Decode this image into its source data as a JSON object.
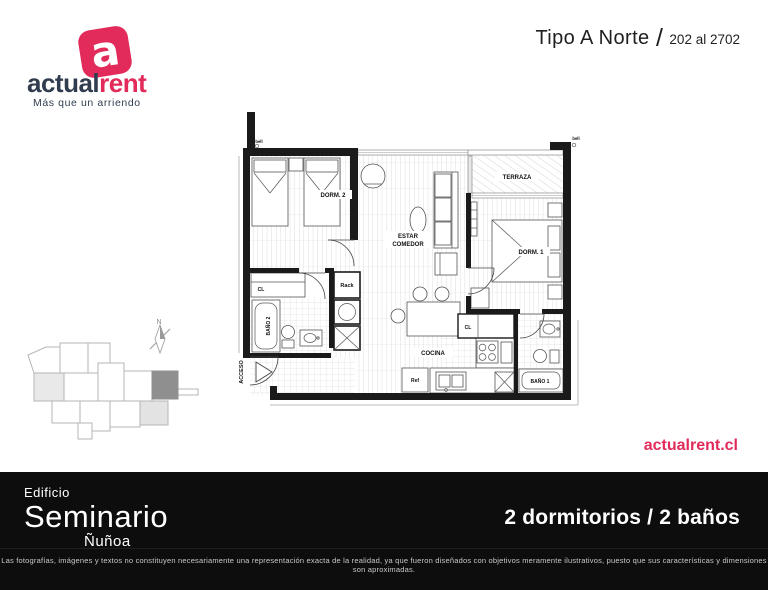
{
  "colors": {
    "accent": "#e22b5a",
    "navy": "#303d4f",
    "footer_bg": "#0d0d0d",
    "wall": "#1a1a1a",
    "keyplan_highlight": "#8f8f8f"
  },
  "header": {
    "logo": {
      "icon_letter": "a",
      "brand_bold": "actual",
      "brand_accent": "rent",
      "tagline": "Más que un arriendo"
    },
    "unit_type": "Tipo A Norte",
    "separator": "/",
    "unit_range": "202 al 2702"
  },
  "floorplan": {
    "labels": {
      "bell_left": "bell",
      "bell_right": "bell",
      "dorm2": "DORM. 2",
      "terraza": "TERRAZA",
      "estar": "ESTAR",
      "comedor": "COMEDOR",
      "dorm1": "DORM. 1",
      "cl_left": "CL",
      "cl_right": "CL",
      "bano2": "BAÑO 2",
      "rack": "Rack",
      "cocina": "COCINA",
      "ref": "Ref",
      "bano1": "BAÑO 1",
      "acceso": "ACCESO"
    }
  },
  "keyplan": {
    "north_label": "N"
  },
  "website": "actualrent.cl",
  "footer": {
    "building_label": "Edificio",
    "building_name": "Seminario",
    "district": "Ñuñoa",
    "features": "2 dormitorios / 2 baños",
    "disclaimer": "Las fotografías, imágenes y textos no constituyen necesariamente una representación exacta de la realidad, ya que fueron diseñados con objetivos meramente ilustrativos, puesto que sus características y dimensiones son aproximadas."
  }
}
